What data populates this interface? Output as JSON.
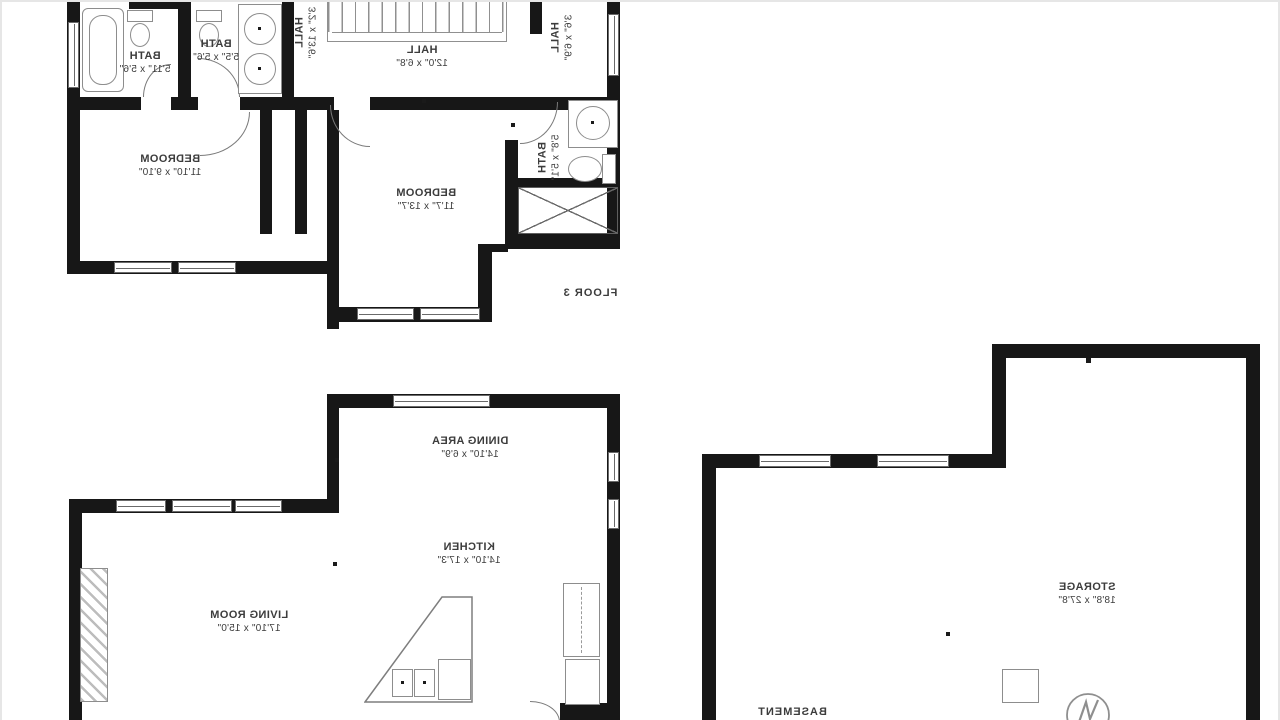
{
  "colors": {
    "wall": "#171717",
    "fixture_outline": "#8d8d8d",
    "text": "#3c3c3c",
    "background": "#ffffff"
  },
  "floor3": {
    "floor_label": "FLOOR 3",
    "bath_left": {
      "name": "BATH",
      "dims": "5'11\" x 5'6\""
    },
    "bath_mid": {
      "name": "BATH",
      "dims": "5'5\" x 5'6\""
    },
    "hall_left": {
      "name": "HALL",
      "dims": "3'2\" x 13'6\""
    },
    "hall_center": {
      "name": "HALL",
      "dims": "12'0\" x 6'8\""
    },
    "hall_right": {
      "name": "HALL",
      "dims": "3'6\" x 6'9\""
    },
    "bedroom_left": {
      "name": "BEDROOM",
      "dims": "11'10\" x 9'10\""
    },
    "bedroom_main": {
      "name": "BEDROOM",
      "dims": "11'7\" x 13'7\""
    },
    "bath_right": {
      "name": "BATH",
      "dims": "5'8\" x 5'1\""
    }
  },
  "main_floor": {
    "dining": {
      "name": "DINING AREA",
      "dims": "14'10\" x 6'9\""
    },
    "kitchen": {
      "name": "KITCHEN",
      "dims": "14'10\" x 17'3\""
    },
    "living": {
      "name": "LIVING ROOM",
      "dims": "17'10\" x 15'0\""
    }
  },
  "basement": {
    "floor_label": "BASEMENT",
    "storage": {
      "name": "STORAGE",
      "dims": "18'8\" x 27'8\""
    }
  }
}
